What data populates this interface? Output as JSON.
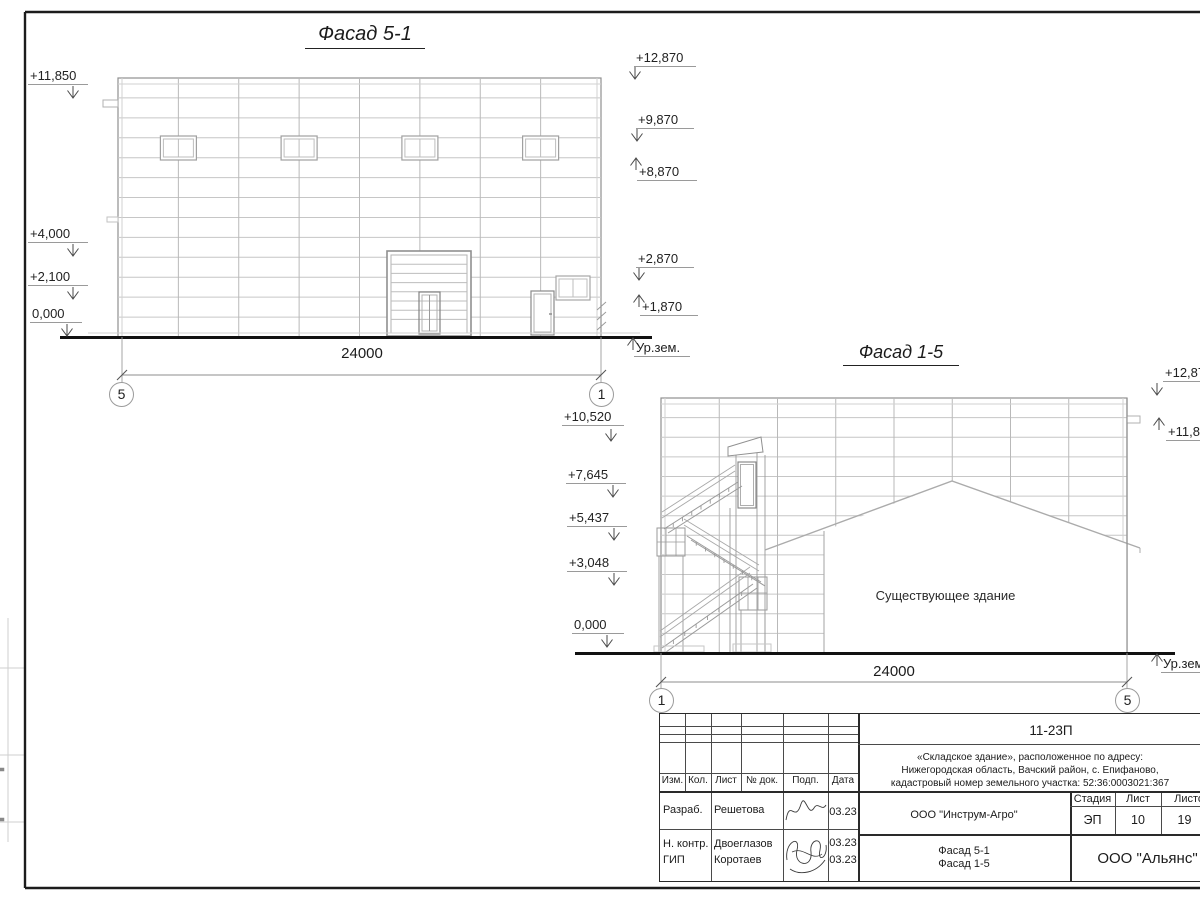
{
  "facade51": {
    "title": "Фасад 5-1",
    "marks_left": [
      "+11,850",
      "+4,000",
      "+2,100",
      "0,000"
    ],
    "marks_right": [
      "+12,870",
      "+9,870",
      "+8,870",
      "+2,870",
      "+1,870"
    ],
    "ground_label": "Ур.зем.",
    "dimension": "24000",
    "axis_start": "5",
    "axis_end": "1"
  },
  "facade15": {
    "title": "Фасад 1-5",
    "marks_left": [
      "+10,520",
      "+7,645",
      "+5,437",
      "+3,048",
      "0,000"
    ],
    "marks_right": [
      "+12,870",
      "+11,850"
    ],
    "ground_label": "Ур.зем.",
    "existing_building_label": "Существующее здание",
    "dimension": "24000",
    "axis_start": "1",
    "axis_end": "5"
  },
  "titleblock": {
    "doc_code": "11-23П",
    "description_lines": [
      "«Складское здание», расположенное по адресу:",
      "Нижегородская область, Вачский район, с. Епифаново,",
      "кадастровый номер земельного участка: 52:36:0003021:367"
    ],
    "rev_headers": [
      "Изм.",
      "Кол.",
      "Лист",
      "№ док.",
      "Подп.",
      "Дата"
    ],
    "signers": [
      {
        "role": "Разраб.",
        "name": "Решетова",
        "date": "03.23"
      },
      {
        "role": "Н. контр.",
        "name": "Двоеглазов",
        "date": "03.23"
      },
      {
        "role": "ГИП",
        "name": "Коротаев",
        "date": "03.23"
      }
    ],
    "company": "ООО \"Инструм-Агро\"",
    "stage_label": "Стадия",
    "sheet_label": "Лист",
    "sheets_label": "Листов",
    "stage": "ЭП",
    "sheet_number": "10",
    "sheets_total": "19",
    "content_lines": [
      "Фасад 5-1",
      "Фасад 1-5"
    ],
    "contractor": "ООО \"Альянс\""
  }
}
